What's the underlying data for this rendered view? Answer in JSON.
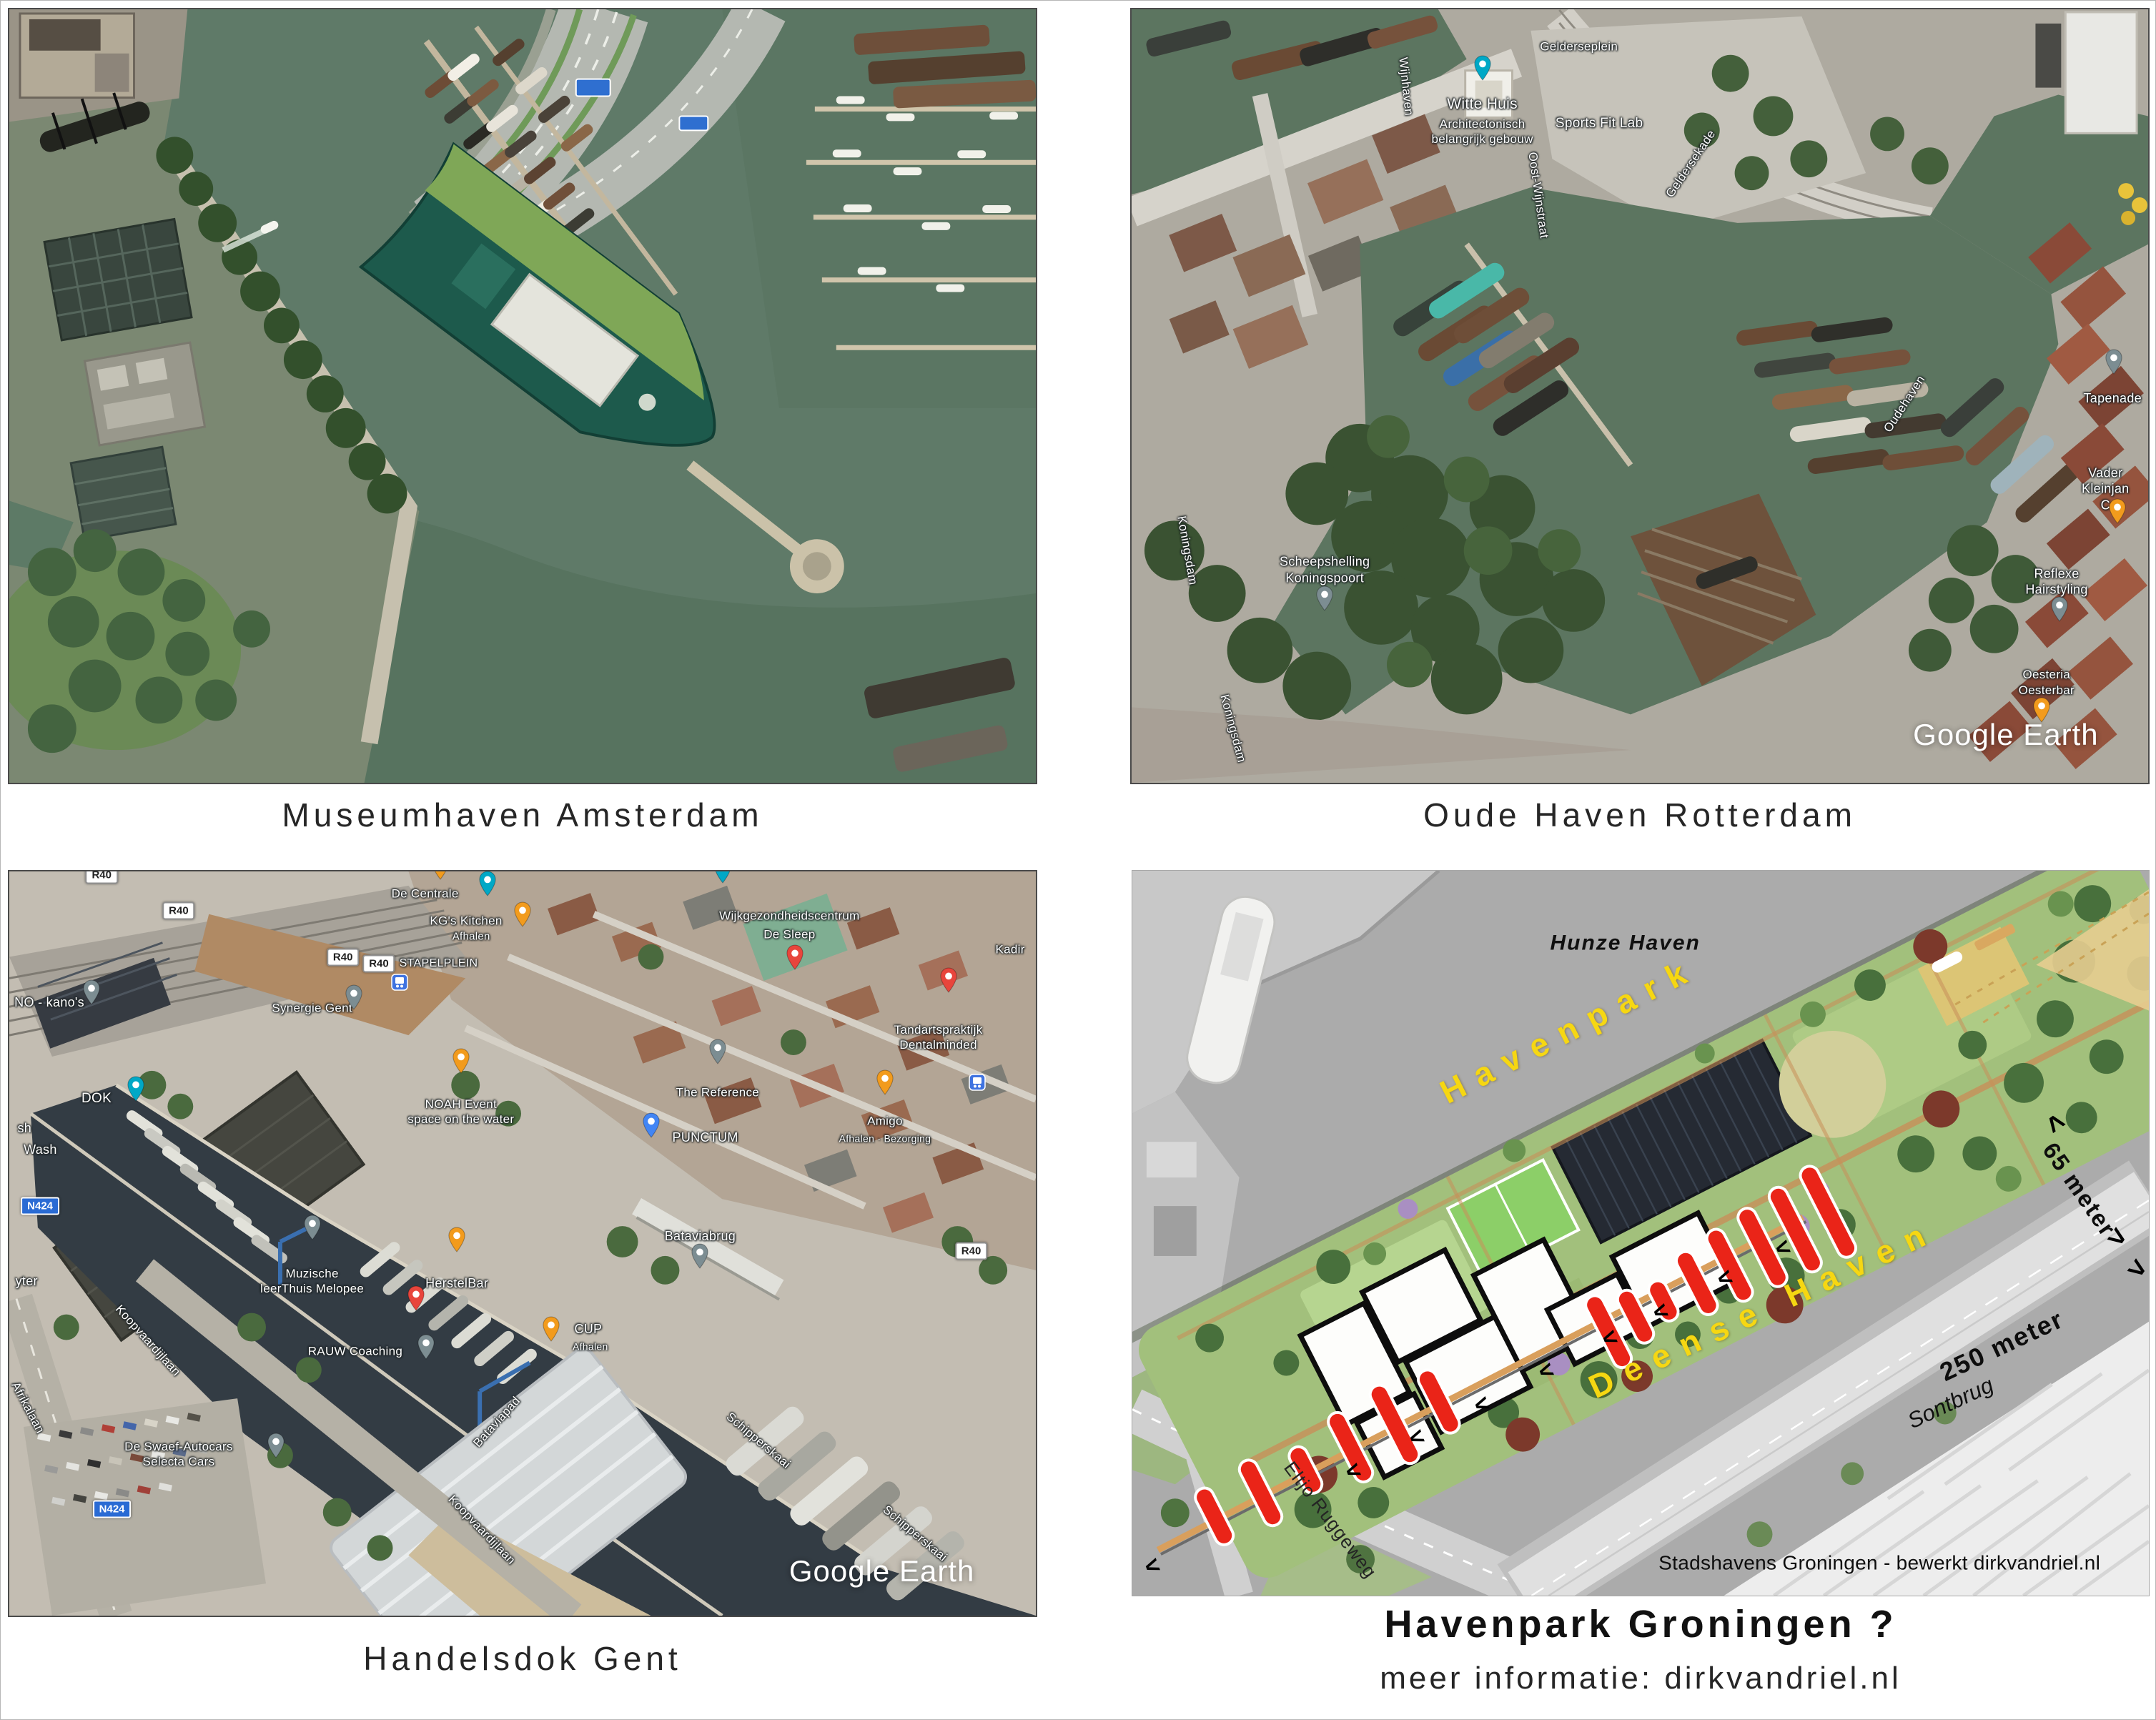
{
  "palette": {
    "pin_orange": "#f29b1d",
    "pin_teal": "#00a8c6",
    "pin_gray": "#7c8d92",
    "pin_blue": "#4285f4",
    "pin_red": "#e8453c",
    "plan_label_yellow": "#f6d712",
    "plan_boat_red": "#ea2418",
    "water_olive": "#5f7a68",
    "water_dark": "#333c44"
  },
  "panels": [
    {
      "id": "amsterdam",
      "caption": "Museumhaven Amsterdam",
      "labels": [],
      "pins": [],
      "shields": []
    },
    {
      "id": "rotterdam",
      "caption": "Oude Haven Rotterdam",
      "watermark": {
        "t": "Google Earth",
        "x": 86,
        "y": 93.8
      },
      "labels": [
        {
          "t": "Gelderseplein",
          "x": 44,
          "y": 4.8
        },
        {
          "t": "Witte Huis",
          "x": 34.5,
          "y": 12.3,
          "s": 21
        },
        {
          "t": "Architectonisch\nbelangrijk gebouw",
          "x": 34.5,
          "y": 15.8
        },
        {
          "t": "Sports Fit Lab",
          "x": 46,
          "y": 14.8,
          "s": 19
        },
        {
          "t": "Oost-Wijnstraat",
          "x": 40,
          "y": 24,
          "r": 82,
          "c": "road"
        },
        {
          "t": "Geldersekade",
          "x": 55,
          "y": 20,
          "r": -56,
          "c": "road"
        },
        {
          "t": "Wijnhaven",
          "x": 27,
          "y": 10,
          "r": 84,
          "c": "road"
        },
        {
          "t": "Koningsdam",
          "x": 5.5,
          "y": 70,
          "r": 80,
          "c": "road"
        },
        {
          "t": "Koningsdam",
          "x": 10,
          "y": 93,
          "r": 75,
          "c": "road"
        },
        {
          "t": "Scheepshelling\nKoningspoort",
          "x": 19,
          "y": 72.5,
          "s": 18
        },
        {
          "t": "Oudehaven",
          "x": 76,
          "y": 51,
          "r": -57,
          "c": "road"
        },
        {
          "t": "Tapenade",
          "x": 96.5,
          "y": 50.3,
          "s": 18
        },
        {
          "t": "Vader Kleinjan C",
          "x": 95.8,
          "y": 62,
          "s": 18
        },
        {
          "t": "Reflexe Hairstyling",
          "x": 91,
          "y": 74,
          "s": 18
        },
        {
          "t": "Oesteria\nOesterbar",
          "x": 90,
          "y": 87
        }
      ],
      "pins": [
        {
          "x": 34.5,
          "y": 9.2,
          "color": "teal",
          "icon": "camera"
        },
        {
          "x": 19,
          "y": 77.8,
          "color": "gray",
          "icon": "dot"
        },
        {
          "x": 96.6,
          "y": 47.2,
          "color": "gray",
          "icon": "dot"
        },
        {
          "x": 97,
          "y": 66.5,
          "color": "orange",
          "icon": "coffee"
        },
        {
          "x": 91.3,
          "y": 79.2,
          "color": "gray",
          "icon": "dot"
        },
        {
          "x": 89.5,
          "y": 92.2,
          "color": "orange",
          "icon": "restaurant"
        }
      ],
      "shields": []
    },
    {
      "id": "gent",
      "caption": "Handelsdok Gent",
      "watermark": {
        "t": "Google Earth",
        "x": 85,
        "y": 94
      },
      "labels": [
        {
          "t": "De Centrale",
          "x": 40.5,
          "y": 3
        },
        {
          "t": "KG's Kitchen",
          "x": 44.5,
          "y": 6.6
        },
        {
          "t": "Afhalen",
          "x": 45,
          "y": 8.8,
          "s": 15
        },
        {
          "t": "Wijkgezondheidscentrum",
          "x": 76,
          "y": 6
        },
        {
          "t": "De Sleep",
          "x": 76,
          "y": 8.5
        },
        {
          "t": "Kadir",
          "x": 97.5,
          "y": 10.5
        },
        {
          "t": "STAPELPLEIN",
          "x": 38,
          "y": 12.4,
          "s": 16,
          "a": "left"
        },
        {
          "t": "Synergie Gent",
          "x": 29.5,
          "y": 18.3
        },
        {
          "t": "Tandartspraktijk\nDentalminded",
          "x": 90.5,
          "y": 22.3
        },
        {
          "t": "DOK",
          "x": 8.5,
          "y": 30.5,
          "s": 19
        },
        {
          "t": "NOAH Event\nspace on the water",
          "x": 44,
          "y": 32.3
        },
        {
          "t": "The Reference",
          "x": 69,
          "y": 29.7
        },
        {
          "t": "PUNCTUM",
          "x": 67.8,
          "y": 35.7,
          "s": 18
        },
        {
          "t": "Amigo",
          "x": 85.3,
          "y": 33.5
        },
        {
          "t": "Afhalen · Bezorging",
          "x": 85.3,
          "y": 35.9,
          "s": 14
        },
        {
          "t": "NO - kano's",
          "x": 0.5,
          "y": 17.6,
          "s": 18,
          "a": "left"
        },
        {
          "t": "sh",
          "x": 0.8,
          "y": 34.5,
          "s": 18,
          "a": "left"
        },
        {
          "t": "Wash",
          "x": 1.4,
          "y": 37.4,
          "s": 18,
          "a": "left"
        },
        {
          "t": "yter",
          "x": 0.6,
          "y": 55,
          "s": 18,
          "a": "left"
        },
        {
          "t": "Afrikalaan",
          "x": 1.8,
          "y": 72,
          "r": 62,
          "c": "road"
        },
        {
          "t": "Koopvaardijlaan",
          "x": 13.5,
          "y": 63,
          "r": 48,
          "c": "road"
        },
        {
          "t": "Muzische\nleerThuis Melopee",
          "x": 29.5,
          "y": 55
        },
        {
          "t": "HerstelBar",
          "x": 43.6,
          "y": 55.3,
          "s": 18
        },
        {
          "t": "RAUW Coaching",
          "x": 33.7,
          "y": 64.5
        },
        {
          "t": "CUP",
          "x": 56.4,
          "y": 61.5,
          "s": 18
        },
        {
          "t": "Afhalen",
          "x": 56.6,
          "y": 63.9,
          "s": 14
        },
        {
          "t": "Bataviabrug",
          "x": 67.3,
          "y": 49,
          "s": 18
        },
        {
          "t": "Bataviapad",
          "x": 47.5,
          "y": 74,
          "r": -48,
          "c": "road"
        },
        {
          "t": "Koopvaardijlaan",
          "x": 46,
          "y": 88.5,
          "r": 46,
          "c": "road"
        },
        {
          "t": "Schipperskaai",
          "x": 73,
          "y": 76.5,
          "r": 40,
          "c": "road"
        },
        {
          "t": "Schipperskaai",
          "x": 88.2,
          "y": 89,
          "r": 40,
          "c": "road"
        },
        {
          "t": "De Swaef-Autocars\nSelecta Cars",
          "x": 16.5,
          "y": 78.3
        }
      ],
      "pins": [
        {
          "x": 42,
          "y": 1.2,
          "color": "orange",
          "icon": "restaurant"
        },
        {
          "x": 46.6,
          "y": 3.4,
          "color": "teal",
          "icon": "flag"
        },
        {
          "x": 50,
          "y": 7.5,
          "color": "orange",
          "icon": "restaurant"
        },
        {
          "x": 69.5,
          "y": 1.6,
          "color": "teal",
          "icon": "dot"
        },
        {
          "x": 76.5,
          "y": 13.3,
          "color": "red",
          "icon": "medical"
        },
        {
          "x": 91.5,
          "y": 16.3,
          "color": "red",
          "icon": "medical"
        },
        {
          "x": 33.6,
          "y": 18.6,
          "color": "gray",
          "icon": "dot"
        },
        {
          "x": 38,
          "y": 16,
          "color": "blue",
          "icon": "transit"
        },
        {
          "x": 12.3,
          "y": 30.9,
          "color": "teal",
          "icon": "bank"
        },
        {
          "x": 44,
          "y": 27.2,
          "color": "orange",
          "icon": "restaurant"
        },
        {
          "x": 69,
          "y": 25.9,
          "color": "gray",
          "icon": "dot"
        },
        {
          "x": 62.5,
          "y": 35.8,
          "color": "blue",
          "icon": "lock"
        },
        {
          "x": 85.3,
          "y": 30.1,
          "color": "orange",
          "icon": "restaurant"
        },
        {
          "x": 94.3,
          "y": 29.5,
          "color": "blue",
          "icon": "transit"
        },
        {
          "x": 8,
          "y": 18,
          "color": "gray",
          "icon": "dot"
        },
        {
          "x": 29.5,
          "y": 49.6,
          "color": "gray",
          "icon": "book"
        },
        {
          "x": 43.6,
          "y": 51.2,
          "color": "orange",
          "icon": "cocktail"
        },
        {
          "x": 39.6,
          "y": 59.1,
          "color": "red",
          "icon": "medical"
        },
        {
          "x": 40.6,
          "y": 65.6,
          "color": "gray",
          "icon": "dot"
        },
        {
          "x": 52.8,
          "y": 63.2,
          "color": "orange",
          "icon": "coffee"
        },
        {
          "x": 67.3,
          "y": 53.4,
          "color": "gray",
          "icon": "bridge"
        },
        {
          "x": 26,
          "y": 78.9,
          "color": "gray",
          "icon": "dot"
        }
      ],
      "shields": [
        {
          "x": 9,
          "y": 0.5,
          "kind": "r40",
          "label": "R40"
        },
        {
          "x": 16.5,
          "y": 5.3,
          "kind": "r40",
          "label": "R40"
        },
        {
          "x": 32.5,
          "y": 11.5,
          "kind": "r40",
          "label": "R40"
        },
        {
          "x": 36,
          "y": 12.4,
          "kind": "r40",
          "label": "R40"
        },
        {
          "x": 93.7,
          "y": 51,
          "kind": "r40",
          "label": "R40"
        },
        {
          "x": 3,
          "y": 45,
          "kind": "n424",
          "label": "N424"
        },
        {
          "x": 10,
          "y": 85.7,
          "kind": "n424",
          "label": "N424"
        }
      ]
    },
    {
      "id": "groningen",
      "caption": "Havenpark Groningen ?",
      "subcaption": "meer informatie: dirkvandriel.nl",
      "labels": [
        {
          "t": "Hunze Haven",
          "x": 48.5,
          "y": 10,
          "c": "plan-italic"
        },
        {
          "t": "Havenpark",
          "x": 43,
          "y": 22,
          "r": -27,
          "c": "plan-yellow"
        },
        {
          "t": "Deense Haven",
          "x": 62,
          "y": 60.5,
          "r": -25,
          "c": "plan-yellow"
        },
        {
          "t": "65 meter",
          "x": 93.2,
          "y": 44,
          "r": 55,
          "c": "plan-black"
        },
        {
          "t": "250 meter",
          "x": 85.5,
          "y": 65.5,
          "r": -25,
          "c": "plan-black",
          "s": 36
        },
        {
          "t": "Sontbrug",
          "x": 80.5,
          "y": 73.5,
          "r": -25,
          "c": "plan-sont"
        },
        {
          "t": "Eltjo Ruggeweg",
          "x": 19.5,
          "y": 89.5,
          "r": 53,
          "c": "plan-road"
        },
        {
          "t": "Stadshavens Groningen -  bewerkt dirkvandriel.nl",
          "x": 73.5,
          "y": 95.5,
          "c": "plan-credit"
        },
        {
          "t": "<",
          "x": 90.8,
          "y": 34.8,
          "r": 55,
          "c": "chev2"
        },
        {
          "t": ">",
          "x": 96.9,
          "y": 50.6,
          "r": 35,
          "c": "chev2"
        },
        {
          "t": ">",
          "x": 98.9,
          "y": 54.9,
          "r": 35,
          "c": "chev2"
        },
        {
          "t": "<",
          "x": 2,
          "y": 96,
          "r": -20,
          "c": "chev"
        },
        {
          "t": "<",
          "x": 21.7,
          "y": 82.8,
          "r": -20,
          "c": "chev"
        },
        {
          "t": "<",
          "x": 28,
          "y": 78.2,
          "r": -20,
          "c": "chev"
        },
        {
          "t": "<",
          "x": 34.4,
          "y": 73.7,
          "r": -20,
          "c": "chev"
        },
        {
          "t": "<",
          "x": 40.7,
          "y": 69,
          "r": -20,
          "c": "chev"
        },
        {
          "t": "<",
          "x": 47,
          "y": 64.5,
          "r": -20,
          "c": "chev"
        },
        {
          "t": "<",
          "x": 52,
          "y": 60.8,
          "r": -20,
          "c": "chev"
        },
        {
          "t": "<",
          "x": 58.3,
          "y": 56.2,
          "r": -20,
          "c": "chev"
        },
        {
          "t": "<",
          "x": 64,
          "y": 52.1,
          "r": -20,
          "c": "chev"
        }
      ],
      "pins": [],
      "shields": []
    }
  ]
}
